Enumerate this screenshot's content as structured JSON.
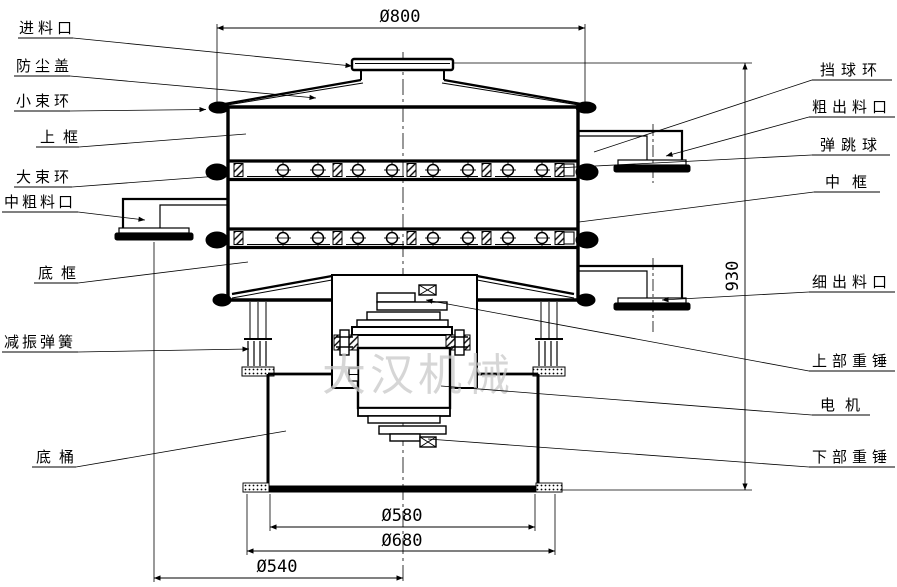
{
  "drawing": {
    "watermark": "大汉机械",
    "dimensions": {
      "top_diameter": "Ø800",
      "total_height": "930",
      "base_inner_diameter": "Ø580",
      "base_outer_diameter": "Ø680",
      "bottom_diameter": "Ø540"
    },
    "labels_left": {
      "feed_inlet": "进料口",
      "dust_cover": "防尘盖",
      "small_clamp_ring": "小束环",
      "upper_frame": "上框",
      "large_clamp_ring": "大束环",
      "mid_coarse_outlet": "中粗料口",
      "bottom_frame": "底框",
      "damping_spring": "减振弹簧",
      "base_barrel": "底桶"
    },
    "labels_right": {
      "ball_blocking_ring": "挡球环",
      "coarse_outlet": "粗出料口",
      "bouncing_ball": "弹跳球",
      "middle_frame": "中框",
      "fine_outlet": "细出料口",
      "upper_weight": "上部重锤",
      "motor": "电机",
      "lower_weight": "下部重锤"
    }
  }
}
